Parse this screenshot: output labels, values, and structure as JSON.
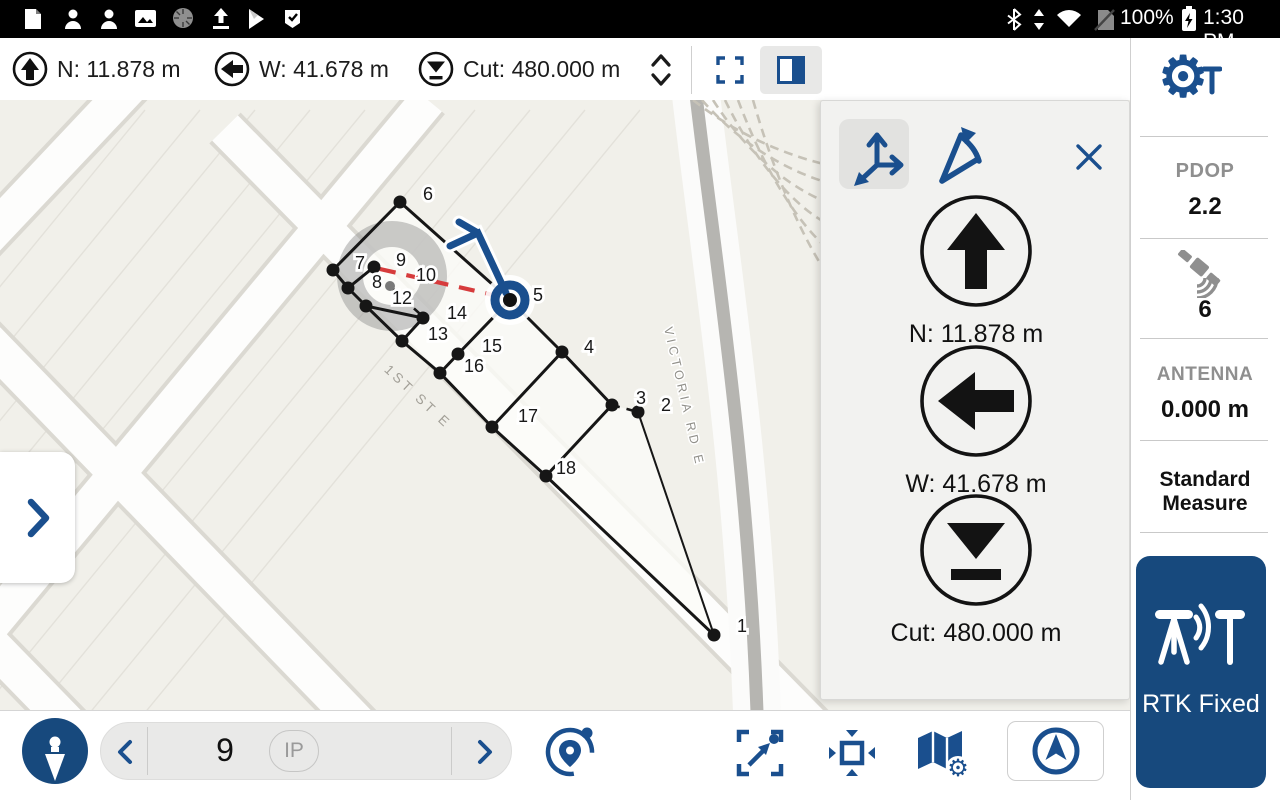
{
  "status_bar": {
    "time": "1:30 PM",
    "battery_percent": "100%",
    "icons_left": [
      "note-icon",
      "contacts-icon",
      "contacts-icon",
      "gallery-icon",
      "disc-icon",
      "upload-icon",
      "play-store-icon",
      "tasks-icon"
    ],
    "icons_right": [
      "bluetooth-icon",
      "updown-arrows-icon",
      "wifi-icon",
      "no-sim-icon",
      "battery-icon"
    ]
  },
  "header": {
    "chips": [
      {
        "icon": "north-arrow",
        "label": "N: 11.878 m"
      },
      {
        "icon": "west-arrow",
        "label": "W: 41.678 m"
      },
      {
        "icon": "cut-fill",
        "label": "Cut: 480.000 m"
      }
    ]
  },
  "nav_panel": {
    "mode_buttons": [
      {
        "icon": "axes"
      },
      {
        "icon": "bearing"
      }
    ],
    "rows": [
      {
        "icon": "north-arrow",
        "label": "N: 11.878 m"
      },
      {
        "icon": "west-arrow",
        "label": "W: 41.678 m"
      },
      {
        "icon": "cut-fill",
        "label": "Cut: 480.000 m"
      }
    ]
  },
  "sidebar": {
    "pdop_label": "PDOP",
    "pdop_value": "2.2",
    "satellites_value": "6",
    "antenna_label": "ANTENNA",
    "antenna_value": "0.000 m",
    "measure_method": "Standard Measure",
    "rtk_status": "RTK Fixed"
  },
  "bottom_bar": {
    "point_value": "9",
    "point_badge": "IP"
  },
  "map": {
    "attribution": "© Microsoft",
    "scale": {
      "metric": "50 m",
      "imperial": "200 ft"
    },
    "streets": [
      {
        "name": "1ST ST E"
      },
      {
        "name": "VICTORIA RD E"
      }
    ],
    "accuracy_circle": {
      "x": 392,
      "y": 276,
      "r": 55
    },
    "rover": {
      "x": 510,
      "y": 300,
      "point": "5"
    },
    "vertices": [
      [
        333,
        270
      ],
      [
        348,
        288
      ],
      [
        366,
        306
      ],
      [
        402,
        341
      ],
      [
        440,
        373
      ]
    ],
    "points": [
      {
        "n": "1",
        "dot": [
          714,
          635
        ],
        "lx": 742,
        "ly": 632
      },
      {
        "n": "2",
        "dot": [
          638,
          412
        ],
        "lx": 666,
        "ly": 411
      },
      {
        "n": "3",
        "dot": [
          612,
          405
        ],
        "lx": 641,
        "ly": 404
      },
      {
        "n": "4",
        "dot": [
          562,
          352
        ],
        "lx": 589,
        "ly": 353
      },
      {
        "n": "5",
        "lx": 538,
        "ly": 301
      },
      {
        "n": "6",
        "dot": [
          400,
          202
        ],
        "lx": 428,
        "ly": 200
      },
      {
        "n": "7",
        "dot": [
          374,
          267
        ],
        "lx": 360,
        "ly": 269
      },
      {
        "n": "8",
        "dot": [
          390,
          286
        ],
        "gray": true,
        "lx": 377,
        "ly": 288
      },
      {
        "n": "9",
        "lx": 401,
        "ly": 266
      },
      {
        "n": "10",
        "lx": 426,
        "ly": 281
      },
      {
        "n": "12",
        "lx": 402,
        "ly": 304
      },
      {
        "n": "13",
        "dot": [
          423,
          318
        ],
        "lx": 438,
        "ly": 340
      },
      {
        "n": "14",
        "lx": 457,
        "ly": 319
      },
      {
        "n": "15",
        "dot": [
          458,
          354
        ],
        "lx": 492,
        "ly": 352
      },
      {
        "n": "16",
        "lx": 474,
        "ly": 372
      },
      {
        "n": "17",
        "dot": [
          492,
          427
        ],
        "lx": 528,
        "ly": 422
      },
      {
        "n": "18",
        "dot": [
          546,
          476
        ],
        "lx": 566,
        "ly": 474
      }
    ],
    "lines_solid": [
      [
        333,
        270,
        400,
        202
      ],
      [
        400,
        202,
        510,
        300
      ],
      [
        510,
        300,
        562,
        352
      ],
      [
        562,
        352,
        612,
        405
      ],
      [
        638,
        412,
        714,
        635,
        2
      ],
      [
        714,
        635,
        546,
        476
      ],
      [
        546,
        476,
        492,
        427
      ],
      [
        492,
        427,
        440,
        373
      ],
      [
        440,
        373,
        402,
        341
      ],
      [
        402,
        341,
        366,
        306
      ],
      [
        366,
        306,
        348,
        288
      ],
      [
        348,
        288,
        333,
        270
      ],
      [
        348,
        288,
        374,
        267
      ],
      [
        366,
        306,
        423,
        318
      ],
      [
        423,
        318,
        402,
        341
      ],
      [
        440,
        373,
        458,
        354
      ],
      [
        458,
        354,
        510,
        300
      ],
      [
        492,
        427,
        562,
        352
      ],
      [
        546,
        476,
        612,
        405
      ]
    ],
    "lines_dashed_black": [
      [
        612,
        405,
        638,
        412
      ],
      [
        392,
        288,
        420,
        314
      ]
    ],
    "line_dashed_red": [
      380,
      269,
      502,
      297
    ]
  },
  "colors": {
    "accent": "#1a4f8e",
    "rtk_bg": "#17497d",
    "map_line": "#161616",
    "nav_red": "#d63b3c"
  }
}
